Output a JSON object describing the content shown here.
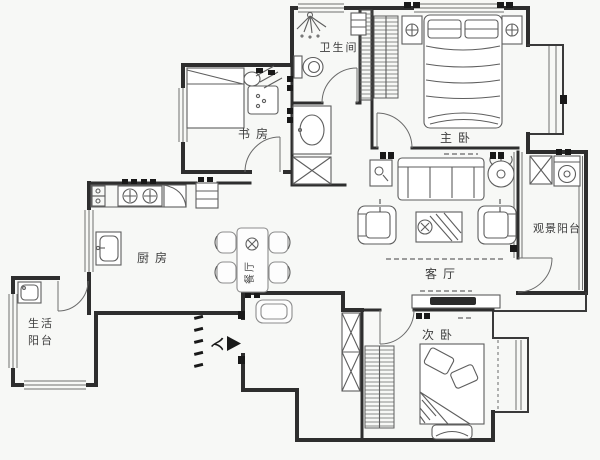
{
  "rooms": {
    "study": {
      "label": "书房"
    },
    "bathroom": {
      "label": "卫生间"
    },
    "master": {
      "label": "主卧"
    },
    "view_balcony": {
      "label": "观景阳台"
    },
    "living": {
      "label": "客厅"
    },
    "dining": {
      "label": "餐厅"
    },
    "kitchen": {
      "label": "厨房"
    },
    "life_balcony": {
      "line1": "生活",
      "line2": "阳台"
    },
    "second": {
      "label": "次卧"
    }
  },
  "entrance": {
    "label": "入"
  },
  "palette": {
    "wall": "#2e2e2e",
    "furniture_line": "#5e5e5e",
    "light_line": "#8d8d8d",
    "background": "#f7f8f6",
    "text": "#3d3d3d",
    "marker": "#191919"
  }
}
